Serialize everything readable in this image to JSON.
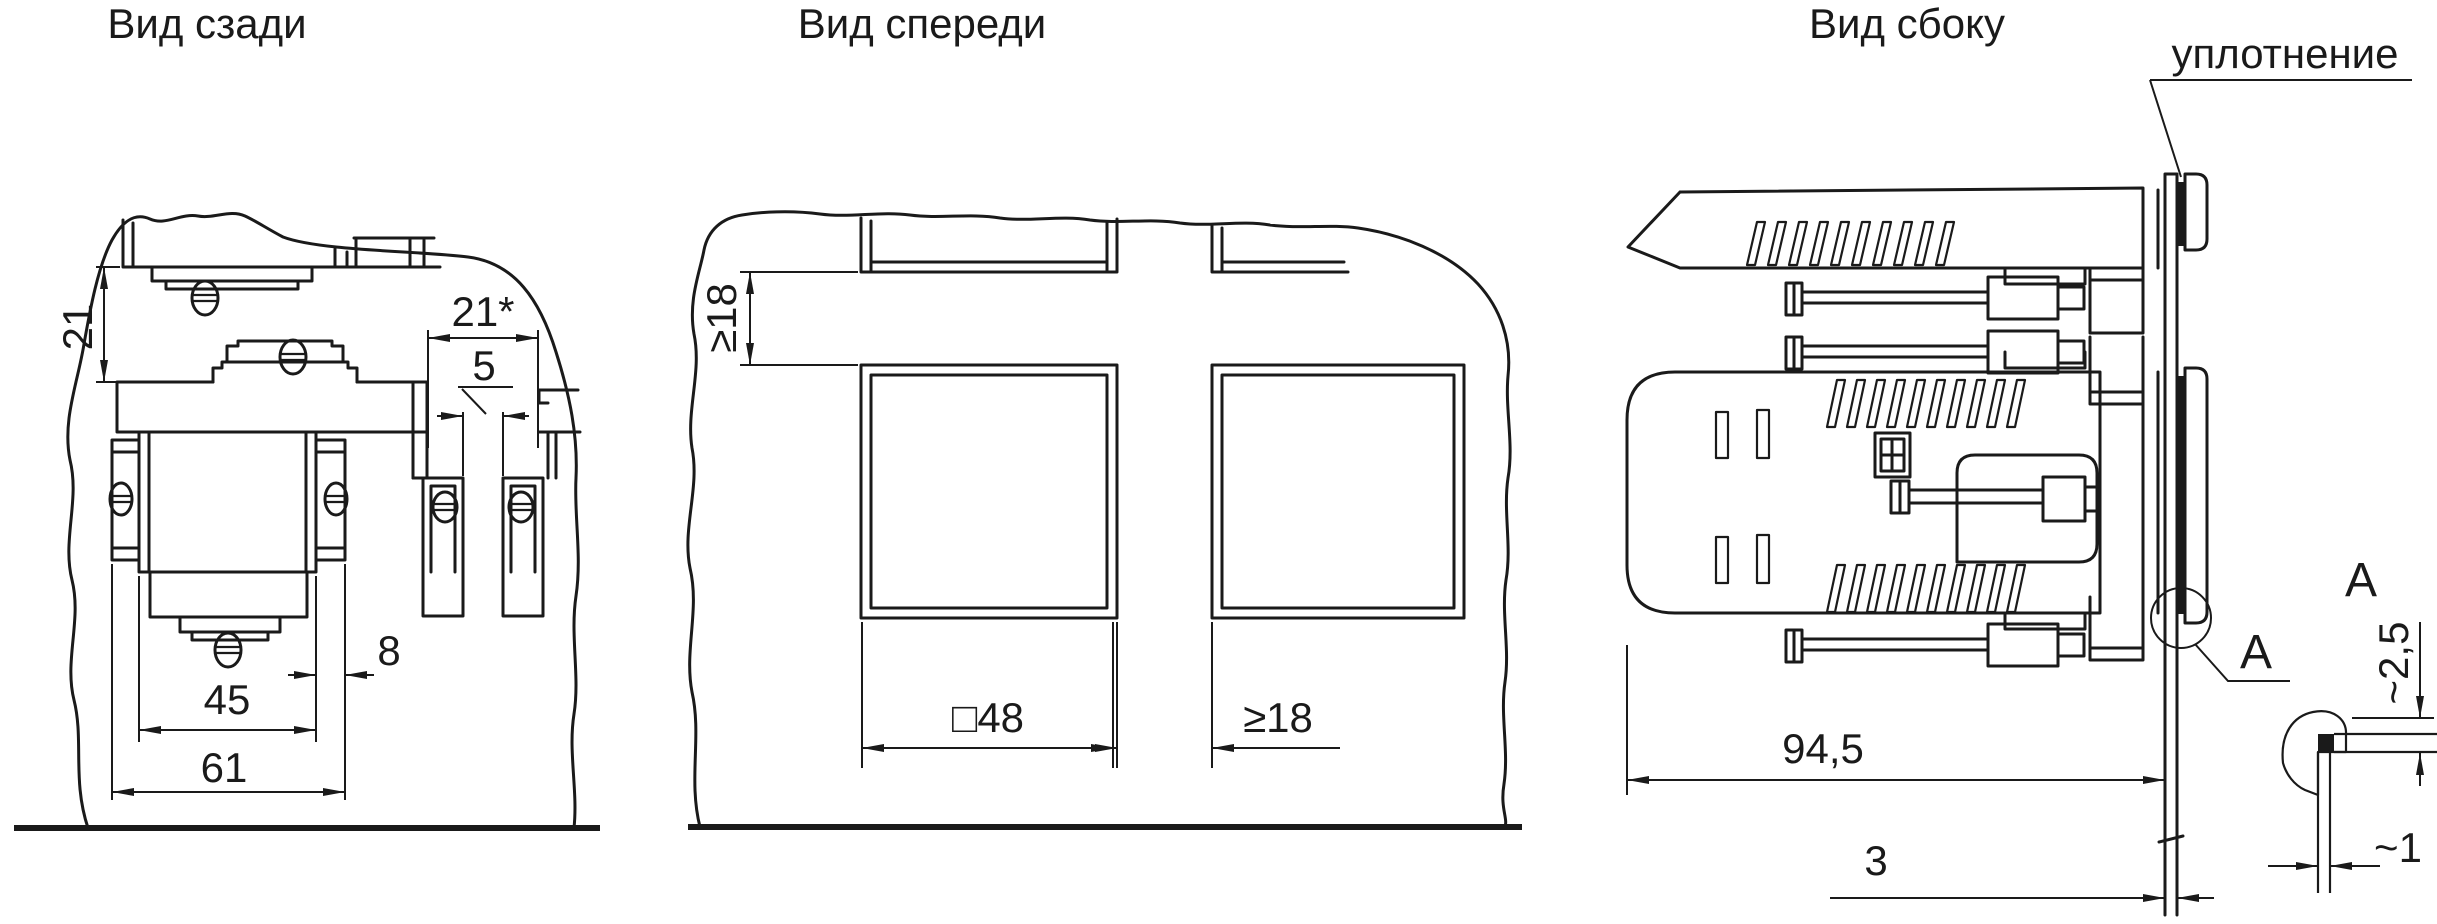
{
  "meta": {
    "background_color": "#ffffff",
    "line_color": "#1a1a1a"
  },
  "views": {
    "rear": {
      "title": "Вид сзади",
      "dims": {
        "clamp_gap_v": "21",
        "unit_pitch": "21*",
        "unit_gap": "5",
        "bracket_offset": "8",
        "body_width": "45",
        "overall_width": "61"
      }
    },
    "front": {
      "title": "Вид спереди",
      "dims": {
        "vertical_clearance": "≥18",
        "cutout_size": "□48",
        "horizontal_clearance": "≥18"
      }
    },
    "side": {
      "title": "Вид сбоку",
      "seal_callout": "уплотнение",
      "dims": {
        "depth": "94,5",
        "panel_thickness": "3",
        "seal_height": "~2,5",
        "seal_width": "~1"
      },
      "detail_marker": "А",
      "detail_label": "А"
    }
  }
}
